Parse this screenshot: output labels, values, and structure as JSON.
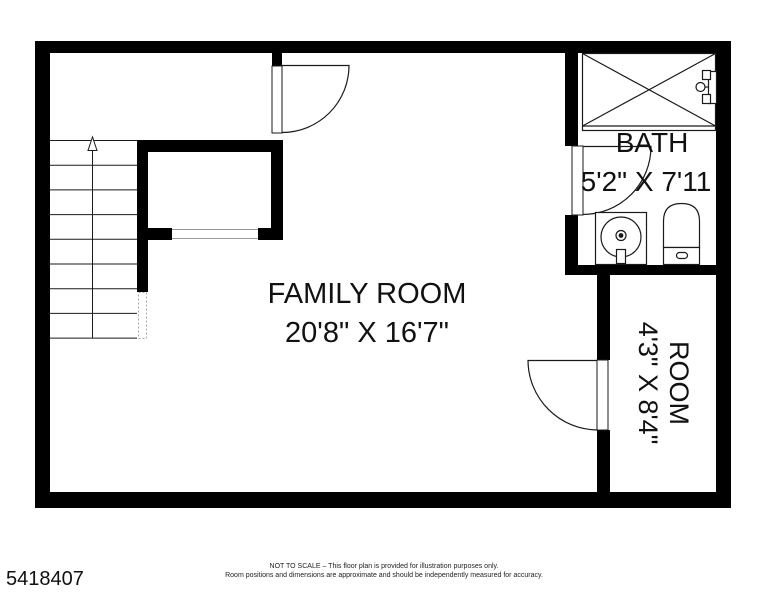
{
  "plan": {
    "rooms": [
      {
        "id": "family_room",
        "label": "FAMILY ROOM",
        "dimensions": "20'8\" X 16'7\""
      },
      {
        "id": "bath",
        "label": "BATH",
        "dimensions": "5'2\" X 7'11"
      },
      {
        "id": "room",
        "label": "ROOM",
        "dimensions": "4'3\" X 8'4\""
      }
    ],
    "fixtures": [
      "shower-tub-icon",
      "tub-faucet-icon",
      "sink-icon",
      "toilet-icon",
      "stairs-up-arrow-icon",
      "door-swing-icon"
    ],
    "stairs": {
      "direction": "up",
      "steps": 8
    },
    "colors": {
      "wall": "#000000",
      "background": "#ffffff",
      "line": "#1a1a1a",
      "thin_line": "#999999"
    }
  },
  "footer": {
    "listing_number": "5418407",
    "disclaimer_line1": "NOT TO SCALE – This floor plan is provided for illustration purposes only.",
    "disclaimer_line2": "Room positions and dimensions are approximate and should be independently measured for accuracy."
  }
}
